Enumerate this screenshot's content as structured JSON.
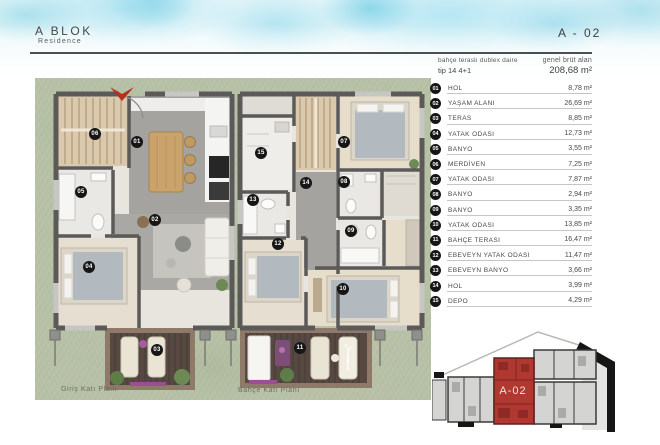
{
  "header": {
    "block_title": "A BLOK",
    "block_subtitle": "Residence",
    "unit_code": "A - 02"
  },
  "unit_info": {
    "type_desc": "bahçe teraslı dublex daire",
    "type_code": "tip 14 4+1",
    "gross_label": "genel brüt alan",
    "gross_value": "208,68 m²"
  },
  "rooms": [
    {
      "no": "01",
      "name": "HOL",
      "area": "8,78 m²"
    },
    {
      "no": "02",
      "name": "YAŞAM ALANI",
      "area": "26,69 m²"
    },
    {
      "no": "03",
      "name": "TERAS",
      "area": "8,85 m²"
    },
    {
      "no": "04",
      "name": "YATAK ODASI",
      "area": "12,73 m²"
    },
    {
      "no": "05",
      "name": "BANYO",
      "area": "3,55 m²"
    },
    {
      "no": "06",
      "name": "MERDİVEN",
      "area": "7,25 m²"
    },
    {
      "no": "07",
      "name": "YATAK ODASI",
      "area": "7,87 m²"
    },
    {
      "no": "08",
      "name": "BANYO",
      "area": "2,94 m²"
    },
    {
      "no": "09",
      "name": "BANYO",
      "area": "3,35 m²"
    },
    {
      "no": "10",
      "name": "YATAK ODASI",
      "area": "13,85 m²"
    },
    {
      "no": "11",
      "name": "BAHÇE TERASI",
      "area": "16,47 m²"
    },
    {
      "no": "12",
      "name": "EBEVEYN YATAK ODASI",
      "area": "11,47 m²"
    },
    {
      "no": "13",
      "name": "EBEVEYN BANYO",
      "area": "3,66 m²"
    },
    {
      "no": "14",
      "name": "HOL",
      "area": "3,99 m²"
    },
    {
      "no": "15",
      "name": "DEPO",
      "area": "4,29 m²"
    }
  ],
  "plans": {
    "ground_label": "Giriş Katı Planı",
    "garden_label": "Bahçe Katı Planı"
  },
  "markers": {
    "m01": "01",
    "m02": "02",
    "m03": "03",
    "m04": "04",
    "m05": "05",
    "m06": "06",
    "m07": "07",
    "m08": "08",
    "m09": "09",
    "m10": "10",
    "m11": "11",
    "m12": "12",
    "m13": "13",
    "m14": "14",
    "m15": "15"
  },
  "keyplan": {
    "highlight_label": "A-02"
  },
  "colors": {
    "accent_red": "#b23220",
    "keyplan_highlight": "#b13831",
    "grass": "#b7c1a6",
    "deck": "#574842",
    "wall": "#5b5a58",
    "watercolor_blue": "#9fd8e8"
  }
}
